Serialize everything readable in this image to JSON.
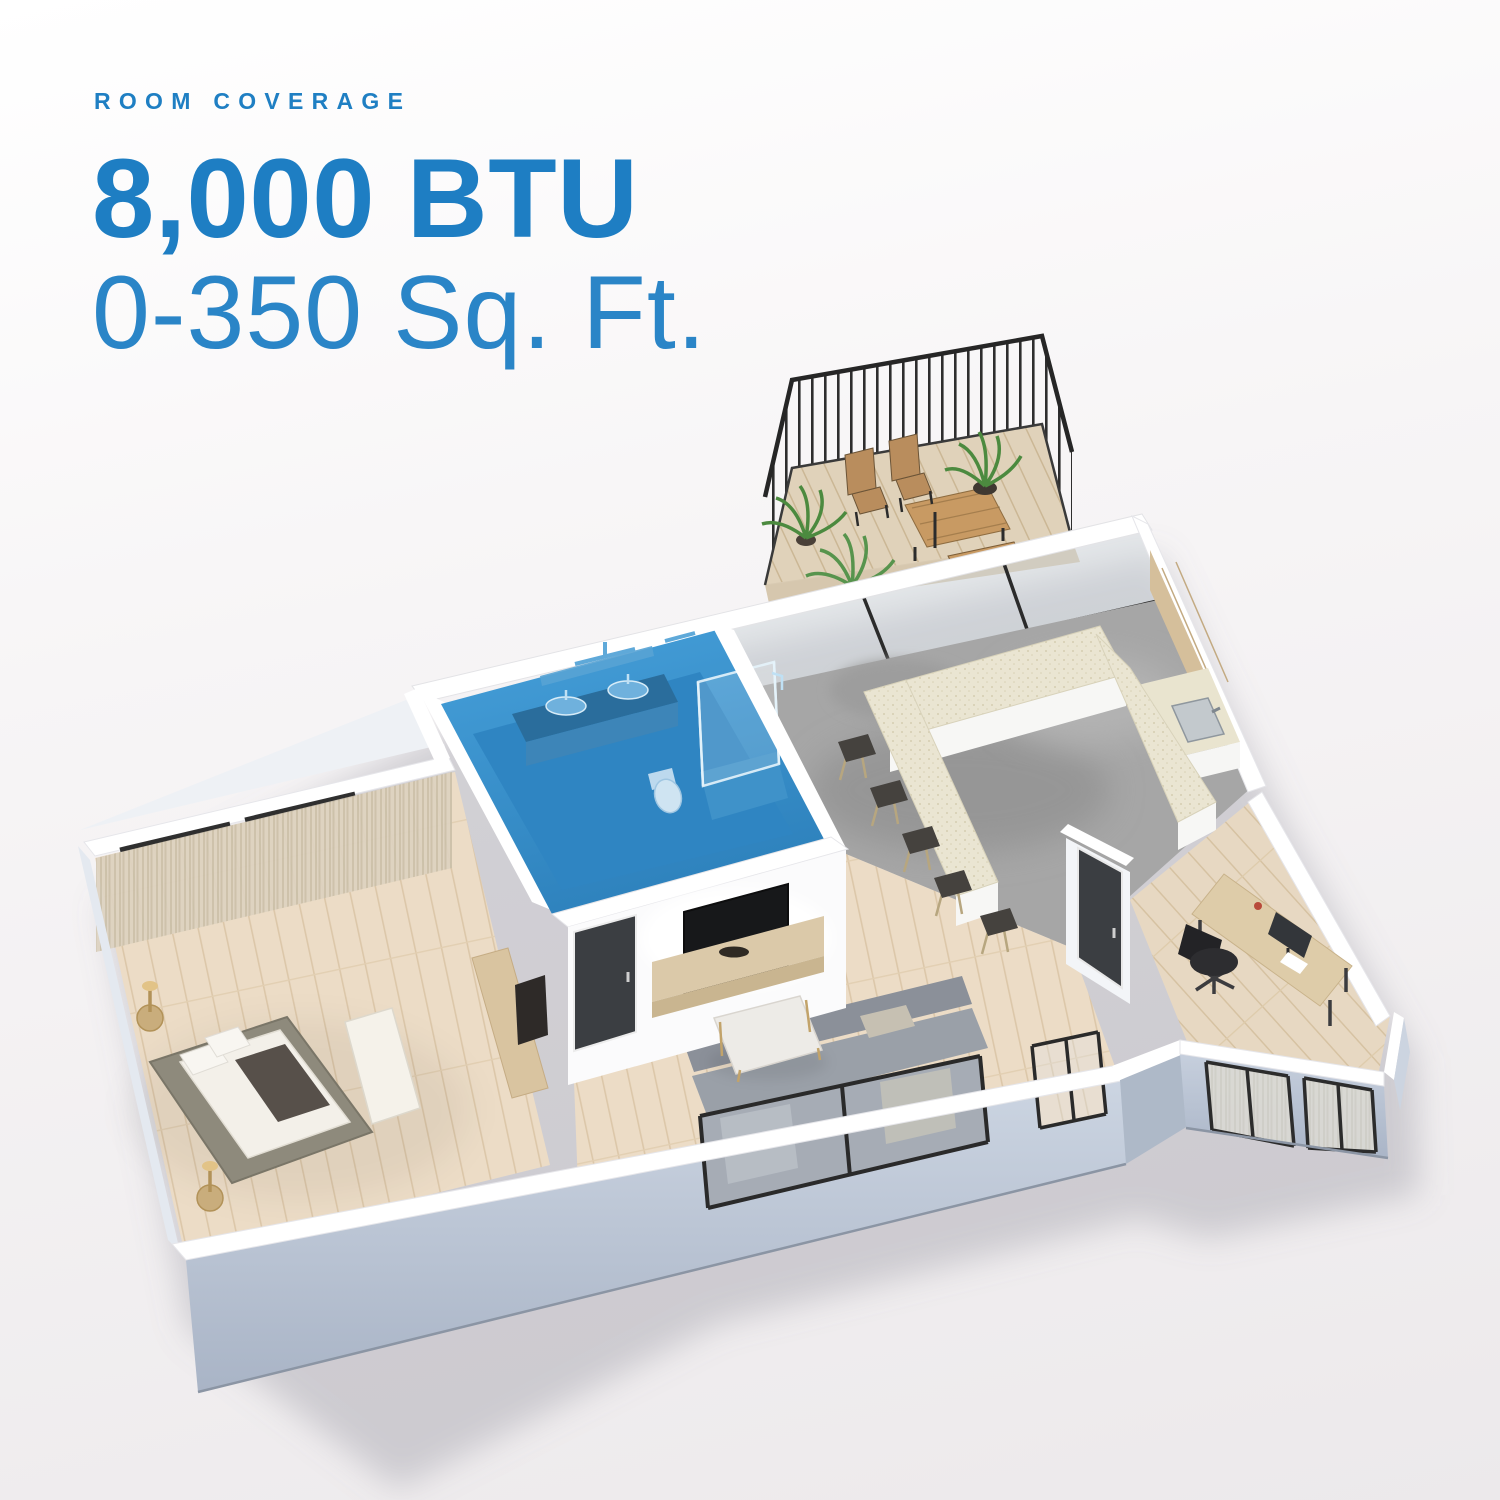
{
  "header": {
    "eyebrow": "ROOM COVERAGE",
    "line1": "8,000 BTU",
    "line2": "0-350 Sq. Ft.",
    "text_color": "#1F7FC3"
  },
  "floorplan": {
    "type": "isometric-3d-apartment-render",
    "highlight": {
      "room": "bathroom",
      "color": "#3B92CE",
      "meaning": "room size covered by the 8,000 BTU unit"
    },
    "rooms": [
      {
        "name": "bedroom",
        "floor": "light-wood",
        "furniture": [
          "platform-bed",
          "white-bench",
          "two-nightstands",
          "gold-table-lamps",
          "sheer-curtains",
          "low-media-console",
          "leaning-art"
        ]
      },
      {
        "name": "bathroom",
        "highlighted": true,
        "floor": "blue-highlight",
        "furniture": [
          "double-sink-vanity",
          "mirror",
          "wall-niche",
          "glass-walk-in-shower",
          "toilet"
        ]
      },
      {
        "name": "living-room",
        "floor": "light-wood",
        "furniture": [
          "wall-tv",
          "wood-media-console",
          "decor-bowl",
          "marble-coffee-table",
          "gray-sectional-sofa",
          "dark-interior-door",
          "sliding-glass-doors"
        ]
      },
      {
        "name": "kitchen-dining",
        "floor": "gray-concrete",
        "furniture": [
          "u-shaped-island",
          "five-bar-stools",
          "tall-wood-cabinets",
          "counter-with-sink",
          "full-height-glass-wall"
        ]
      },
      {
        "name": "home-office",
        "floor": "light-wood",
        "furniture": [
          "wood-desk",
          "monitor",
          "black-office-chair",
          "dark-interior-door",
          "front-windows"
        ]
      },
      {
        "name": "balcony",
        "floor": "wood-deck",
        "furniture": [
          "black-metal-railing",
          "outdoor-dining-table",
          "outdoor-bench",
          "two-slat-chairs",
          "potted-plants"
        ]
      }
    ]
  }
}
